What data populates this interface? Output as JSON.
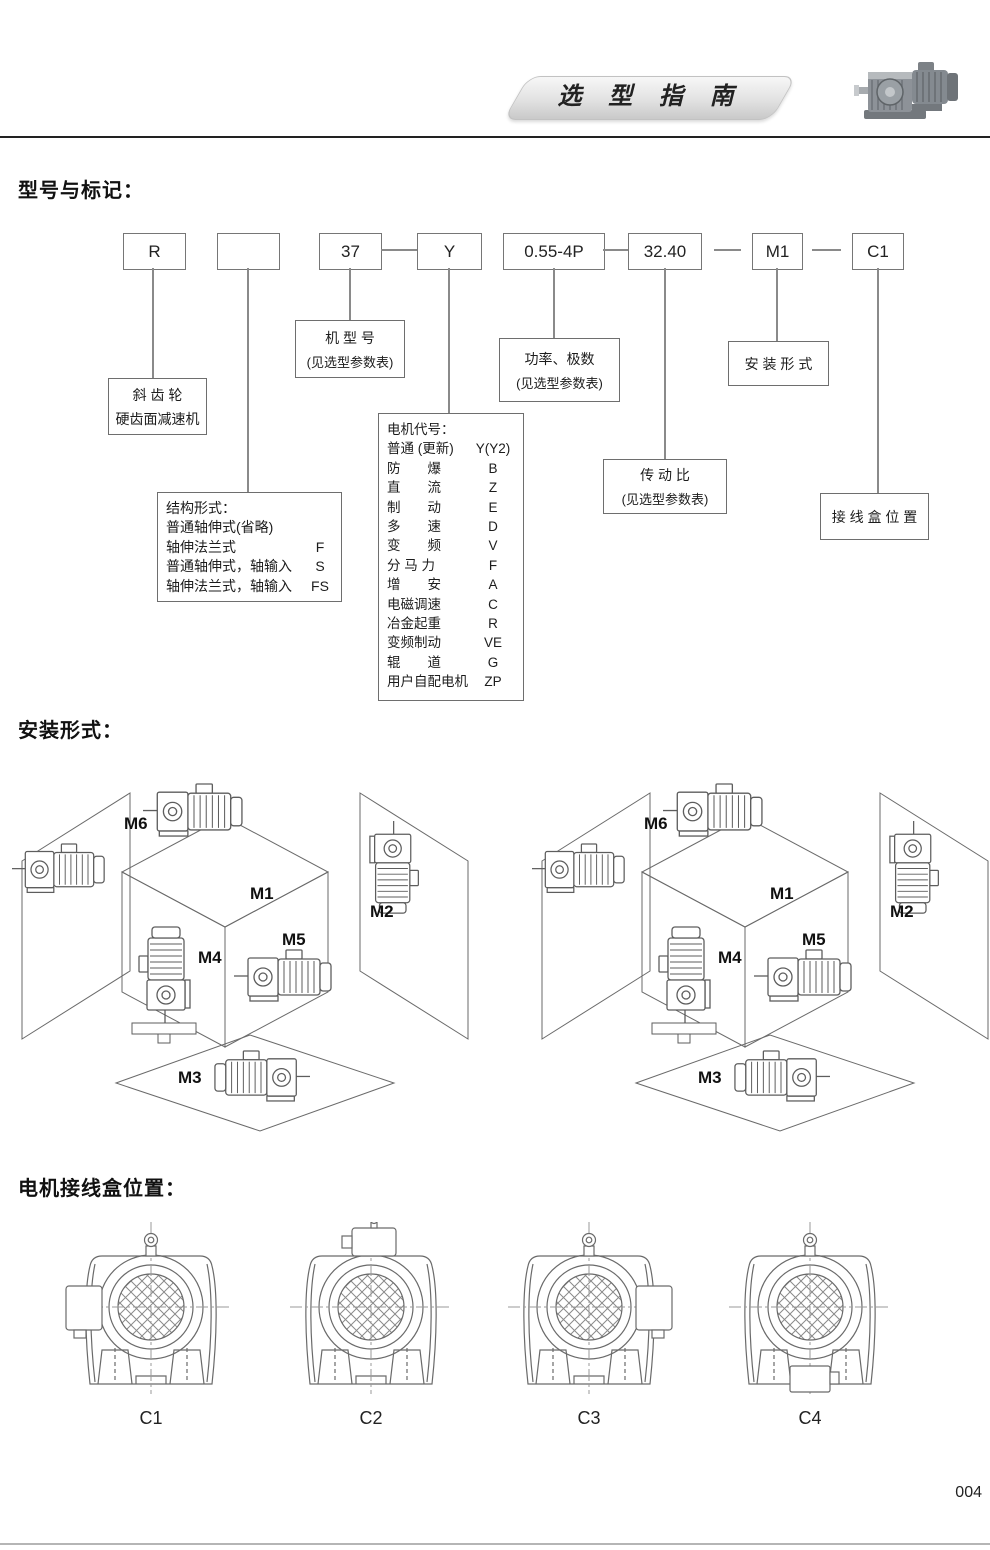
{
  "header": {
    "title": "选 型 指 南",
    "product_image": "gear-motor-photo"
  },
  "model_section": {
    "heading": "型号与标记：",
    "code_boxes": [
      "R",
      "",
      "37",
      "Y",
      "0.55-4P",
      "32.40",
      "M1",
      "C1"
    ],
    "callouts": {
      "reducer": {
        "line1": "斜 齿 轮",
        "line2": "硬齿面减速机"
      },
      "model_no": {
        "line1": "机 型 号",
        "line2": "(见选型参数表)"
      },
      "power": {
        "line1": "功率、极数",
        "line2": "(见选型参数表)"
      },
      "mounting": {
        "line1": "安 装 形 式"
      },
      "ratio": {
        "line1": "传 动 比",
        "line2": "(见选型参数表)"
      },
      "junction": {
        "line1": "接 线 盒 位 置"
      },
      "structure": {
        "title": "结构形式：",
        "rows": [
          {
            "label": "普通轴伸式(省略)",
            "code": ""
          },
          {
            "label": "轴伸法兰式",
            "code": "F"
          },
          {
            "label": "普通轴伸式，轴输入",
            "code": "S"
          },
          {
            "label": "轴伸法兰式，轴输入",
            "code": "FS"
          }
        ]
      },
      "motor_code": {
        "title": "电机代号：",
        "rows": [
          {
            "label": "普通 (更新)",
            "code": "Y(Y2)"
          },
          {
            "label": "防　　爆",
            "code": "B"
          },
          {
            "label": "直　　流",
            "code": "Z"
          },
          {
            "label": "制　　动",
            "code": "E"
          },
          {
            "label": "多　　速",
            "code": "D"
          },
          {
            "label": "变　　频",
            "code": "V"
          },
          {
            "label": "分 马 力",
            "code": "F"
          },
          {
            "label": "增　　安",
            "code": "A"
          },
          {
            "label": "电磁调速",
            "code": "C"
          },
          {
            "label": "冶金起重",
            "code": "R"
          },
          {
            "label": "变频制动",
            "code": "VE"
          },
          {
            "label": "辊　　道",
            "code": "G"
          },
          {
            "label": "用户自配电机",
            "code": "ZP"
          }
        ]
      }
    }
  },
  "mounting_section": {
    "heading": "安装形式：",
    "labels": [
      "M1",
      "M2",
      "M3",
      "M4",
      "M5",
      "M6"
    ]
  },
  "junction_section": {
    "heading": "电机接线盒位置：",
    "labels": [
      "C1",
      "C2",
      "C3",
      "C4"
    ]
  },
  "page": {
    "number": "004"
  }
}
